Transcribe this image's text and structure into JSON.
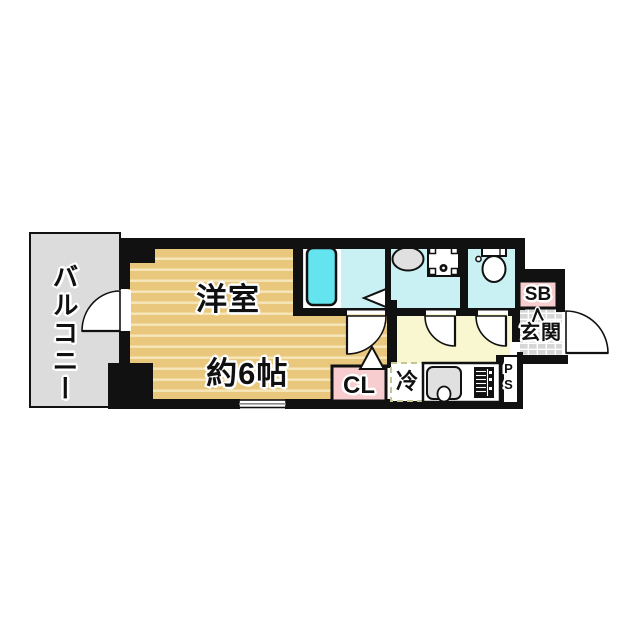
{
  "plan": {
    "type": "apartment-floor-plan",
    "labels": {
      "balcony": "バルコニー",
      "main_room_line1": "洋室",
      "main_room_line2": "約6帖",
      "closet": "CL",
      "refrigerator": "冷",
      "pipe_space": "PS",
      "shoe_box": "SB",
      "entrance": "玄関"
    },
    "colors": {
      "wall": "#111111",
      "tan": "#e9c87e",
      "tan-stripe": "#f6e6ba",
      "cyan": "#c9f1f4",
      "tub": "#63e4ee",
      "yellow": "#f9f7d0",
      "pink": "#f8cdd0",
      "gray": "#dcdcdc",
      "tile": "#d6d6d6",
      "fixture": "#e0e0e0",
      "dash": "#c5c595"
    }
  }
}
